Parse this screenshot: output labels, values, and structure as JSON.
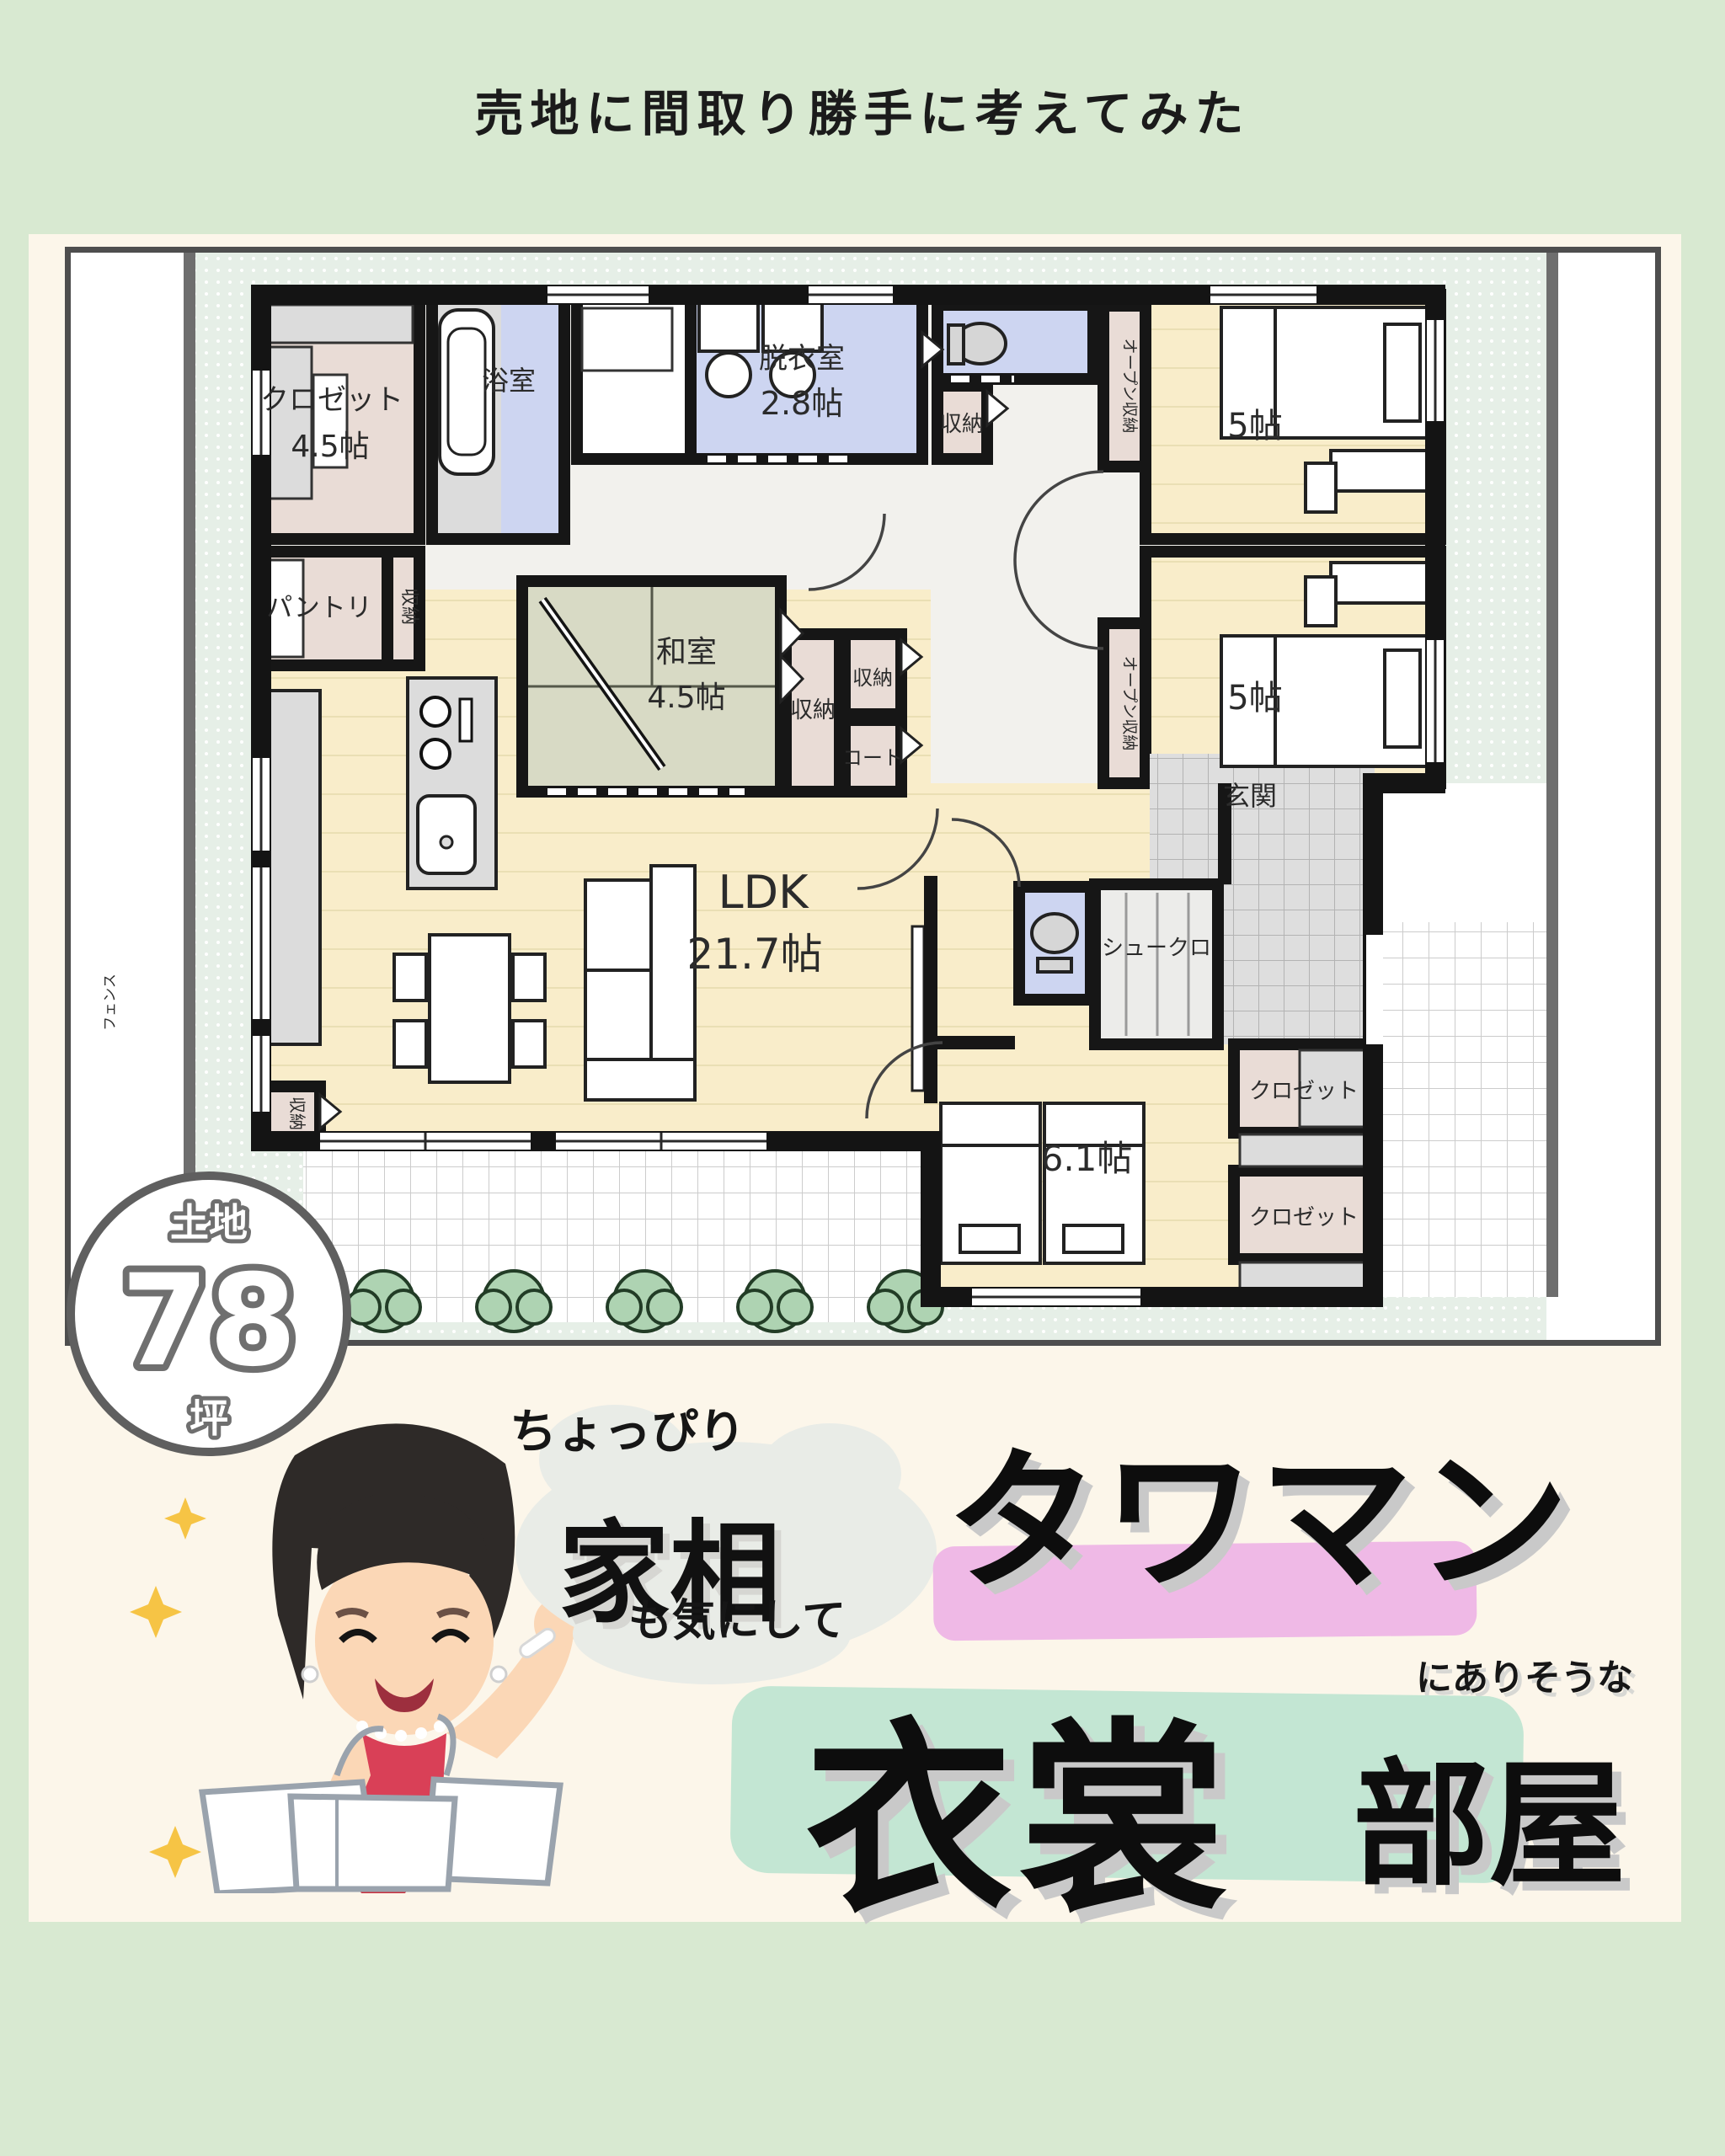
{
  "page": {
    "title": "売地に間取り勝手に考えてみた"
  },
  "badge": {
    "label_top": "土地",
    "number": "78",
    "label_bottom": "坪"
  },
  "floorplan": {
    "fence_label": "フェンス",
    "rooms": [
      {
        "name": "walk-in-closet",
        "label": "クロゼット",
        "size": "4.5帖"
      },
      {
        "name": "bathroom",
        "label": "浴室"
      },
      {
        "name": "dressing-room",
        "label": "脱衣室",
        "size": "2.8帖"
      },
      {
        "name": "hall-storage",
        "label": "収納"
      },
      {
        "name": "open-storage-1",
        "label": "オープン収納"
      },
      {
        "name": "bedroom-1",
        "size": "5帖"
      },
      {
        "name": "open-storage-2",
        "label": "オープン収納"
      },
      {
        "name": "bedroom-2",
        "size": "5帖"
      },
      {
        "name": "pantry",
        "label": "パントリ"
      },
      {
        "name": "pantry-storage",
        "label": "収納"
      },
      {
        "name": "japanese-room",
        "label": "和室",
        "size": "4.5帖"
      },
      {
        "name": "washitsu-storage",
        "label": "収納"
      },
      {
        "name": "small-storage",
        "label": "収納"
      },
      {
        "name": "coat-closet",
        "label": "コート"
      },
      {
        "name": "genkan",
        "label": "玄関"
      },
      {
        "name": "ldk",
        "label": "LDK",
        "size": "21.7帖"
      },
      {
        "name": "shoe-closet",
        "label": "シュークロ"
      },
      {
        "name": "ldk-storage",
        "label": "収納"
      },
      {
        "name": "bedroom-3",
        "size": "6.1帖"
      },
      {
        "name": "closet-1",
        "label": "クロゼット"
      },
      {
        "name": "closet-2",
        "label": "クロゼット"
      }
    ]
  },
  "caption": {
    "prefix": "ちょっぴり",
    "highlight1": "家相",
    "suffix1": "も気にして",
    "highlight2": "タワマン",
    "connector": "にありそうな",
    "main1": "衣裳",
    "main2": "部屋"
  }
}
